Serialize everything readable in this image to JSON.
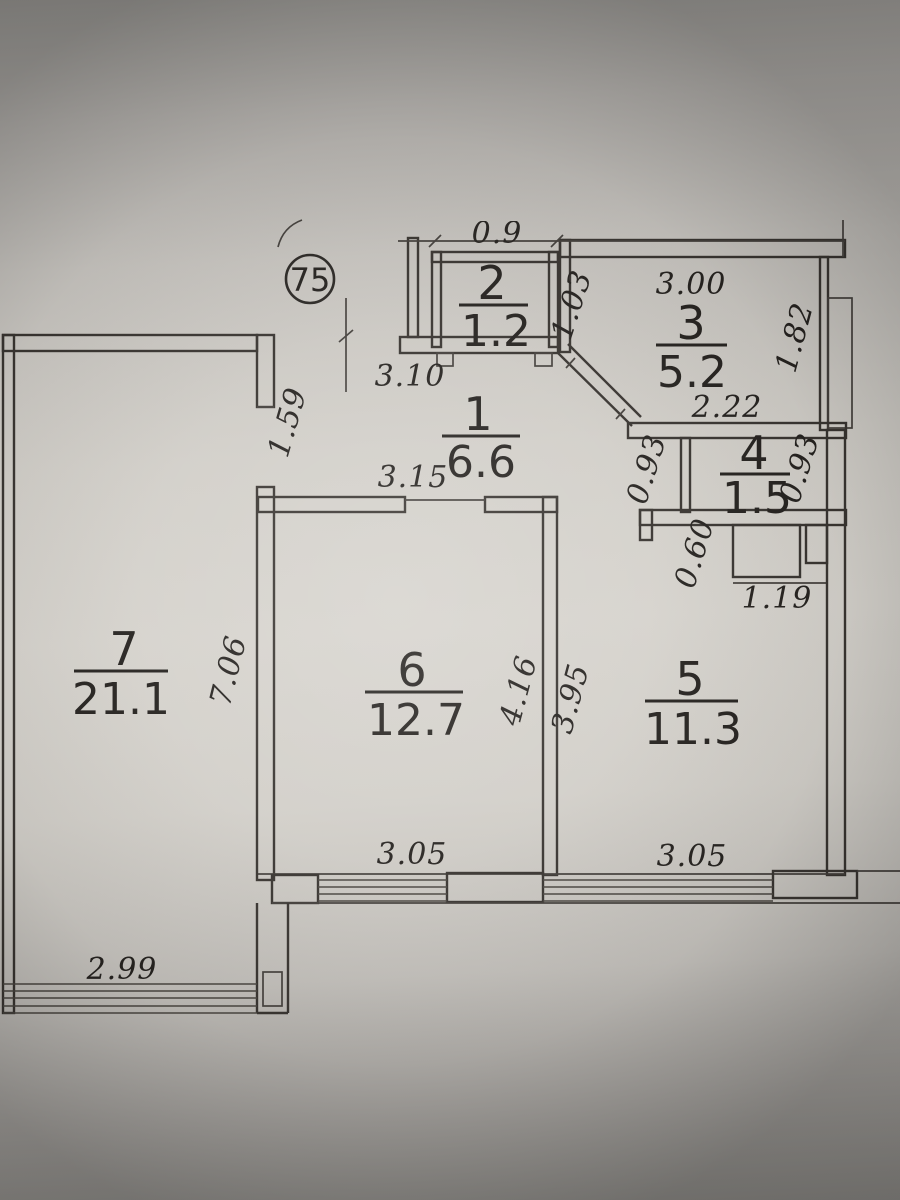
{
  "floor_plan": {
    "apartment_number": "75",
    "rooms": [
      {
        "id": "1",
        "area": "6.6"
      },
      {
        "id": "2",
        "area": "1.2"
      },
      {
        "id": "3",
        "area": "5.2"
      },
      {
        "id": "4",
        "area": "1.5"
      },
      {
        "id": "5",
        "area": "11.3"
      },
      {
        "id": "6",
        "area": "12.7"
      },
      {
        "id": "7",
        "area": "21.1"
      }
    ],
    "dimensions": {
      "top_partial": "0.9",
      "hall_width": "3.10",
      "hall_depth": "1.59",
      "hall_length": "3.15",
      "room3_top": "3.00",
      "room3_diagonal": "1.03",
      "room3_right": "1.82",
      "room3_bottom": "2.22",
      "room4_left": "0.93",
      "room4_right": "0.93",
      "duct_depth": "0.60",
      "duct_width": "1.19",
      "room7_wall": "7.06",
      "room6_right": "4.16",
      "room5_left": "3.95",
      "room6_window": "3.05",
      "room5_window": "3.05",
      "room7_window": "2.99"
    }
  }
}
